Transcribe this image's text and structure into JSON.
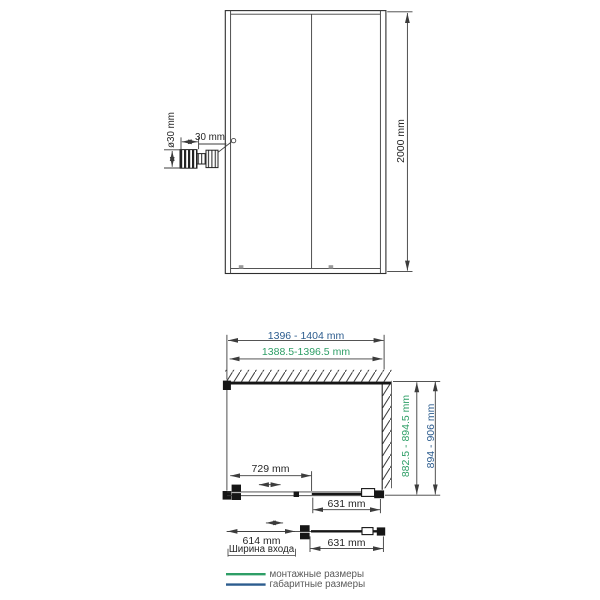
{
  "front_view": {
    "height_dim": "2000 mm",
    "handle_detail": {
      "diameter_dim": "ø30 mm",
      "width_dim": "30 mm"
    }
  },
  "plan_view": {
    "overall_width_dim": "1396 - 1404 mm",
    "mounting_width_dim": "1388.5-1396.5 mm",
    "mounting_depth_dim": "882.5 - 894.5 mm",
    "overall_depth_dim": "894 - 906 mm",
    "door_travel_dim": "729 mm",
    "fixed_panel_dim": "631 mm"
  },
  "open_view": {
    "entry_width_dim": "614 mm",
    "entry_width_caption": "Ширина входа",
    "fixed_panel_dim": "631 mm"
  },
  "legend": {
    "mounting_label": "монтажные размеры",
    "overall_label": "габаритные размеры"
  },
  "colors": {
    "mounting": "#2e9e66",
    "overall": "#2c5c8e"
  }
}
